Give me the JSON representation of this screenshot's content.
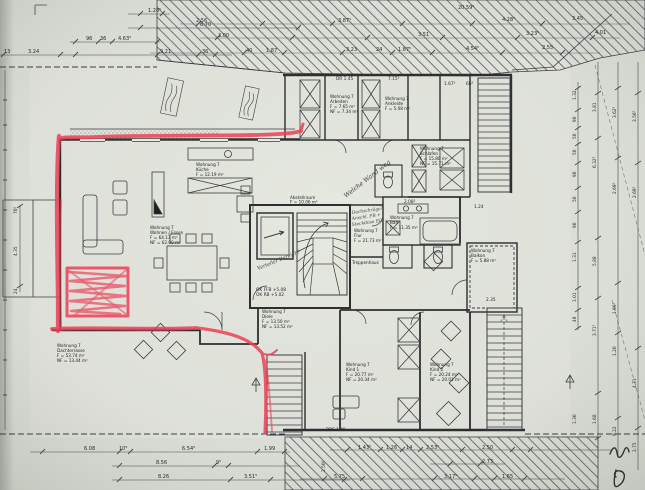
{
  "meta": {
    "apartment": "Wohnung 7",
    "drawing_type": "Dachgeschoss Grundriss (scanned floor plan)"
  },
  "colors": {
    "paper": "#d9dcd4",
    "ink": "#2c2e30",
    "marker_red": "#ee4057"
  },
  "rooms": {
    "wohnen": {
      "lines": [
        "Wohnung 7",
        "Wohnen / Essen",
        "F = 64.13 m²",
        "NF = 62.00 m²"
      ]
    },
    "kueche": {
      "lines": [
        "Wohnung 7",
        "Küche",
        "F = 12.19 m²",
        "NF = 12.04 m²"
      ]
    },
    "arbeiten": {
      "lines": [
        "Wohnung 7",
        "Arbeiten",
        "F = 7.65 m²",
        "NF = 7.34 m²"
      ]
    },
    "ankleide": {
      "lines": [
        "Wohnung 7",
        "Ankleide",
        "F = 5.08 m²",
        "NF = 5.04 m²"
      ]
    },
    "schlafen": {
      "lines": [
        "Wohnung 7",
        "Schlafen",
        "F = 15.80 m²",
        "NF = 15.71 m²"
      ]
    },
    "abstellraum": {
      "lines": [
        "Abstellraum",
        "F = 10.06 m²",
        "NF = 10.28 m²"
      ]
    },
    "treppenhaus": {
      "lines": [
        "Treppenhaus"
      ]
    },
    "diele": {
      "lines": [
        "Wohnung 7",
        "Diele",
        "F = 13.50 m²",
        "NF = 13.52 m²"
      ]
    },
    "flur": {
      "lines": [
        "Wohnung 7",
        "Flur",
        "F = 21.73 m²"
      ]
    },
    "bad": {
      "lines": [
        "Wohnung 7",
        "Bad",
        "F = 11.35 m²"
      ]
    },
    "kind1": {
      "lines": [
        "Wohnung 7",
        "Kind 1",
        "F = 20.77 m²",
        "NF = 20.34 m²"
      ]
    },
    "kind2": {
      "lines": [
        "Wohnung 7",
        "Kind 2",
        "F = 20.24 m²",
        "NF = 20.01 m²"
      ]
    },
    "dachterrasse": {
      "lines": [
        "Wohnung 7",
        "Dachterrasse",
        "F = 53.74 m²",
        "NF = 13.44 m²"
      ]
    },
    "balkon": {
      "lines": [
        "Wohnung 7",
        "Balkon",
        "F = 5.88 m²",
        "NF = 5.71 m²"
      ]
    }
  },
  "annotations": {
    "ok_levels": [
      "OK FFB +5.08",
      "OK RB +5.02"
    ],
    "notes": {
      "wand": "Welche Wand weg",
      "verteiler": "Verteiler Bereich?",
      "dach": [
        "Dachschräge?",
        "Anschl. FB +",
        "Steckdose EG"
      ]
    }
  },
  "dims": {
    "top_left": [
      "1.28⁵",
      "8.70",
      "96",
      "36",
      "4.63⁵",
      "3.24",
      "13",
      "36",
      "9.21"
    ],
    "top_band": [
      "20.59⁵",
      "2.56",
      "3.87⁵",
      "4.28⁵",
      "3.45",
      "3.00",
      "3.51",
      "3.23⁵",
      "4.01",
      "40",
      "1.87",
      "3.23",
      "24",
      "1.87⁵",
      "4.54⁵",
      "2.55"
    ],
    "inner": [
      "DR 1.45",
      "7.15⁵",
      "1.67⁵",
      "66⁵",
      "1.24",
      "2.35",
      "2.08⁵",
      "DBF 1.40"
    ],
    "left": [
      "70⁵",
      "4.35",
      "24"
    ],
    "right_a": [
      "1.32",
      "90",
      "50",
      "50",
      "90",
      "50",
      "90",
      "1.31",
      "1.01",
      "49",
      "1.30"
    ],
    "right_b": [
      "3.81",
      "6.32⁵",
      "5.88",
      "3.71⁵",
      "1.68"
    ],
    "right_c": [
      "3.62⁵",
      "2.69⁵",
      "1.69⁵",
      "1.20",
      "9.22"
    ],
    "right_d": [
      "3.56⁵",
      "2.69⁵",
      "4.71",
      "2.75"
    ],
    "bottom_left": [
      "6.08",
      "10⁵",
      "6.54⁵",
      "1.99",
      "8.56",
      "9⁵",
      "8.26",
      "3.51⁵"
    ],
    "bottom_mid": [
      "1.43⁵",
      "1.26",
      "14",
      "2.53¹",
      "2.50",
      "2.73",
      "2.50⁵",
      "5.75",
      "3.17⁵",
      "1.65"
    ]
  }
}
